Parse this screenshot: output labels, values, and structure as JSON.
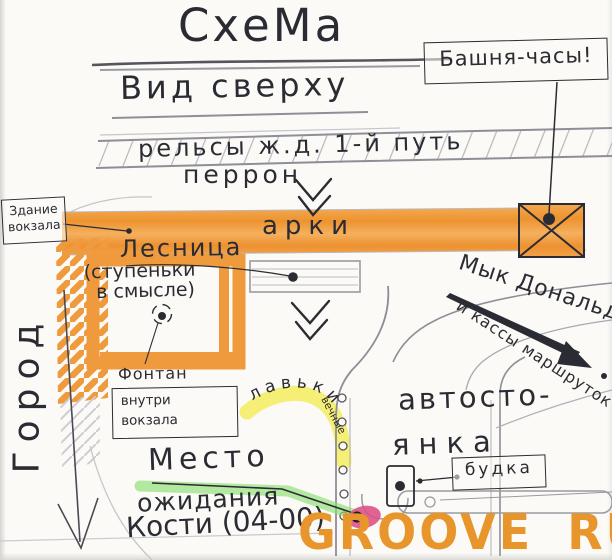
{
  "colors": {
    "paper": "#fbfaf6",
    "ink": "#2b2b33",
    "pencil": "#9a9aa2",
    "marker_orange": "#ef9a3d",
    "highlight_yellow": "#f4ec55",
    "highlight_green": "#86dd6a",
    "highlight_pink": "#db4e84",
    "watermark_orange": "#e8962c"
  },
  "header": {
    "title": "СхеМа",
    "subtitle": "Вид сверху"
  },
  "map": {
    "tower_label": "Башня-часы!",
    "rails_label": "рельсы ж.д.  1-й путь",
    "platform_label": "перрон",
    "station_box": {
      "line1": "Здание",
      "line2": "вокзала"
    },
    "arches_label": "арки",
    "stairs_label": "Лесница",
    "stairs_note": {
      "line1": "(ступеньки",
      "line2": "в смысле)"
    },
    "fountain_label": "Фонтан",
    "fountain_box": {
      "line1": "внутри",
      "line2": "вокзала"
    },
    "city_label": "Город",
    "mcdonalds_label": "Мык Дональдс.",
    "mcdonalds_sub_label": "и кассы маршруток",
    "parking": {
      "line1": "автосто-",
      "line2": "янка"
    },
    "booth_label": "будка",
    "benches_label": "лавьки",
    "benches_note": "вечные",
    "meeting": {
      "line1": "Место",
      "line2": "ожидания",
      "line3": "Кости (04-00)"
    }
  },
  "watermark": {
    "part1": "GROOVE",
    "part2": "RU"
  }
}
